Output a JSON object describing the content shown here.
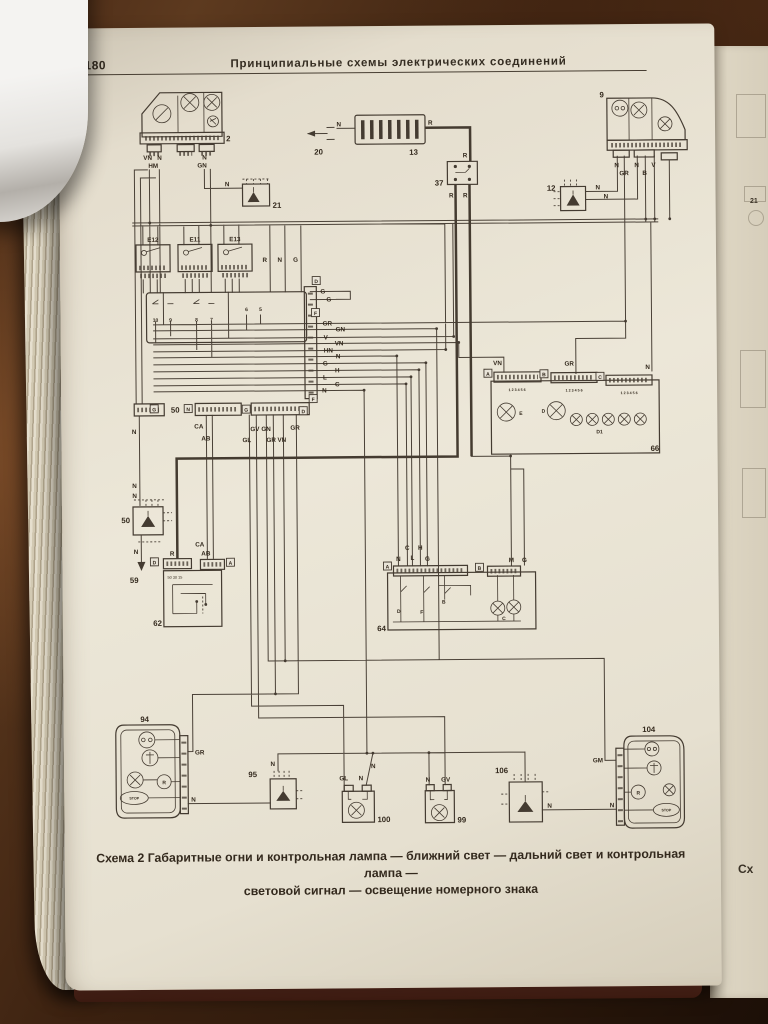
{
  "page": {
    "number": "180",
    "title": "Принципиальные схемы электрических соединений",
    "caption1": "Схема 2 Габаритные огни и контрольная лампа — ближний свет — дальний свет и контрольная лампа —",
    "caption2": "световой сигнал — освещение номерного знака"
  },
  "side_page": {
    "l21": "21",
    "frag": "Сх"
  },
  "colors": {
    "wood": "#3b2110",
    "page": "#e9e3d5",
    "ink": "#443b31",
    "book_edge_red": "#5f2a22"
  },
  "diagram": {
    "headlamp_left": {
      "num": "2",
      "wires": [
        "VN",
        "N",
        "N",
        "HM",
        "GN"
      ]
    },
    "connector_20": {
      "num": "20"
    },
    "fuse_box": {
      "num": "13",
      "wire_in": "N",
      "wire_out": "R"
    },
    "switch_37": {
      "num": "37",
      "wire_top": "R",
      "wires_bottom": [
        "R",
        "R"
      ]
    },
    "headlamp_right": {
      "num": "9",
      "wires": [
        "N",
        "GR",
        "N",
        "B",
        "V"
      ]
    },
    "ground_12": {
      "num": "12",
      "wires": [
        "N",
        "N"
      ]
    },
    "ground_21": {
      "num": "21",
      "wire": "N"
    },
    "relays": {
      "labels": [
        "E12",
        "E11",
        "E13"
      ]
    },
    "column_switch": {
      "num": "50",
      "feed_labels": [
        "R",
        "N",
        "G"
      ],
      "contact_numbers": [
        "10",
        "9",
        "8",
        "7",
        "6",
        "5"
      ],
      "connector_letters": [
        "G",
        "N",
        "G",
        "D",
        "F"
      ],
      "lower_wires": [
        "N",
        "CA",
        "AB",
        "GV",
        "GN",
        "GR",
        "GL",
        "GR",
        "VN"
      ]
    },
    "wire_bus": {
      "labels": [
        "G",
        "G",
        "GR",
        "GN",
        "V",
        "VN",
        "HN",
        "N",
        "G",
        "H",
        "L",
        "C",
        "N"
      ],
      "connector_letters": [
        "D",
        "F"
      ]
    },
    "panel_66": {
      "num": "66",
      "top_wires": [
        "VN",
        "GR",
        "N"
      ],
      "connector_letters": [
        "A",
        "B",
        "C"
      ],
      "pins": "1 2 3 4 5 6",
      "lamp_labels": [
        "E",
        "D"
      ],
      "diode_label": "D1"
    },
    "ground_50": {
      "num": "50",
      "wires": [
        "N",
        "N",
        "N"
      ],
      "point": "59"
    },
    "ignition_62": {
      "num": "62",
      "wires": [
        "R",
        "CA",
        "AB"
      ],
      "terminals": "50 30 15",
      "connector_letters": [
        "D",
        "A"
      ]
    },
    "unit_64": {
      "num": "64",
      "top_wires": [
        "C",
        "H",
        "N",
        "L",
        "G",
        "M",
        "G"
      ],
      "connector_letters": [
        "A",
        "B"
      ],
      "inner_labels": [
        "D",
        "F",
        "B",
        "C"
      ]
    },
    "rear_lamp_left_94": {
      "num": "94",
      "wires": [
        "GR",
        "N"
      ],
      "inner_labels": [
        "R",
        "STOP"
      ]
    },
    "ground_95": {
      "num": "95",
      "wire": "N"
    },
    "plate_lamp_100": {
      "num": "100",
      "wires": [
        "GL",
        "N",
        "N"
      ]
    },
    "plate_lamp_99": {
      "num": "99",
      "wires": [
        "N",
        "GV"
      ]
    },
    "ground_106": {
      "num": "106",
      "wire": "N"
    },
    "rear_lamp_right_104": {
      "num": "104",
      "wires": [
        "GM",
        "N"
      ],
      "inner_labels": [
        "R",
        "STOP"
      ]
    }
  }
}
